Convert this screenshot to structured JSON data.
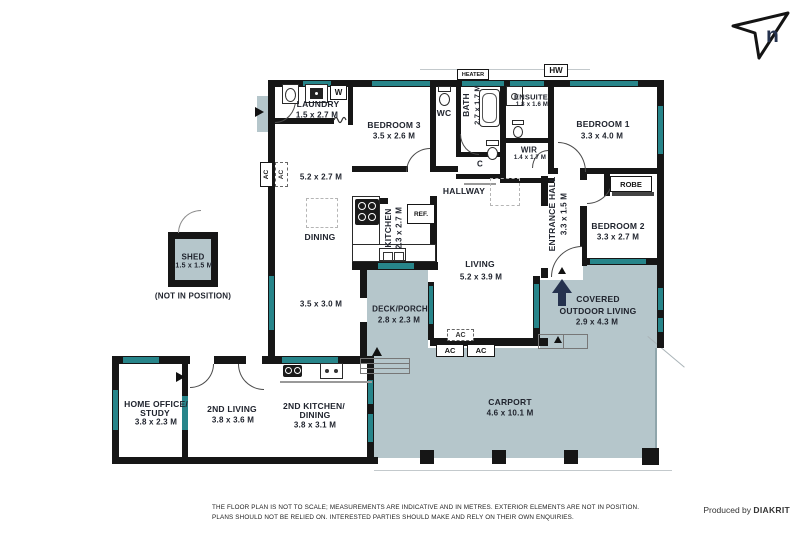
{
  "colors": {
    "wall": "#161616",
    "window": "#27858a",
    "outdoor": "#b5c6cb",
    "navy": "#25324e",
    "ink": "#20242e"
  },
  "compass": {
    "label": "n"
  },
  "rooms": {
    "laundry": {
      "name": "LAUNDRY",
      "dims": "1.5 x 2.7 M"
    },
    "bedroom3": {
      "name": "BEDROOM 3",
      "dims": "3.5 x 2.6 M"
    },
    "wc": {
      "name": "WC"
    },
    "bath": {
      "name": "BATH",
      "dims": "2.7 x 1.7 M"
    },
    "ensuite": {
      "name": "ENSUITE",
      "dims": "1.8 x 1.6 M"
    },
    "bedroom1": {
      "name": "BEDROOM 1",
      "dims": "3.3 x 4.0 M"
    },
    "wir": {
      "name": "WIR",
      "dims": "1.4 x 1.7 M"
    },
    "robe": {
      "name": "ROBE"
    },
    "closet": {
      "name": "C"
    },
    "hallway": {
      "name": "HALLWAY"
    },
    "entrance_hall": {
      "name": "ENTRANCE HALL",
      "dims": "3.3 x 1.5 M"
    },
    "bedroom2": {
      "name": "BEDROOM 2",
      "dims": "3.3 x 2.7 M"
    },
    "dining": {
      "name": "DINING",
      "dims": "5.2 x 2.7 M"
    },
    "kitchen": {
      "name": "KITCHEN",
      "dims": "2.3 x 2.7 M"
    },
    "living": {
      "name": "LIVING",
      "dims": "5.2 x 3.9 M"
    },
    "family_area": {
      "dims": "3.5 x 3.0 M"
    },
    "deck_porch": {
      "name": "DECK/PORCH",
      "dims": "2.8 x 2.3 M"
    },
    "covered_outdoor": {
      "name_line1": "COVERED",
      "name_line2": "OUTDOOR LIVING",
      "dims": "2.9 x 4.3 M"
    },
    "shed": {
      "name": "SHED",
      "dims": "1.5 x 1.5 M",
      "note": "(NOT IN POSITION)"
    },
    "home_office": {
      "name_line1": "HOME OFFICE/",
      "name_line2": "STUDY",
      "dims": "3.8 x 2.3 M"
    },
    "second_living": {
      "name": "2ND LIVING",
      "dims": "3.8 x 3.6 M"
    },
    "second_kitchen": {
      "name_line1": "2ND KITCHEN/",
      "name_line2": "DINING",
      "dims": "3.8 x 3.1 M"
    },
    "carport": {
      "name": "CARPORT",
      "dims": "4.6 x 10.1 M"
    }
  },
  "fixtures": {
    "heater": "HEATER",
    "hot_water": "HW",
    "washer": "W",
    "fridge": "REF.",
    "ac": "AC"
  },
  "footer": {
    "disclaimer_line1": "THE FLOOR PLAN IS NOT TO SCALE; MEASUREMENTS ARE INDICATIVE AND IN METRES. EXTERIOR ELEMENTS ARE NOT IN POSITION.",
    "disclaimer_line2": "PLANS SHOULD NOT BE RELIED ON. INTERESTED PARTIES SHOULD MAKE AND RELY ON THEIR OWN ENQUIRIES.",
    "credit_prefix": "Produced by",
    "credit_brand": "DIAKRIT"
  }
}
